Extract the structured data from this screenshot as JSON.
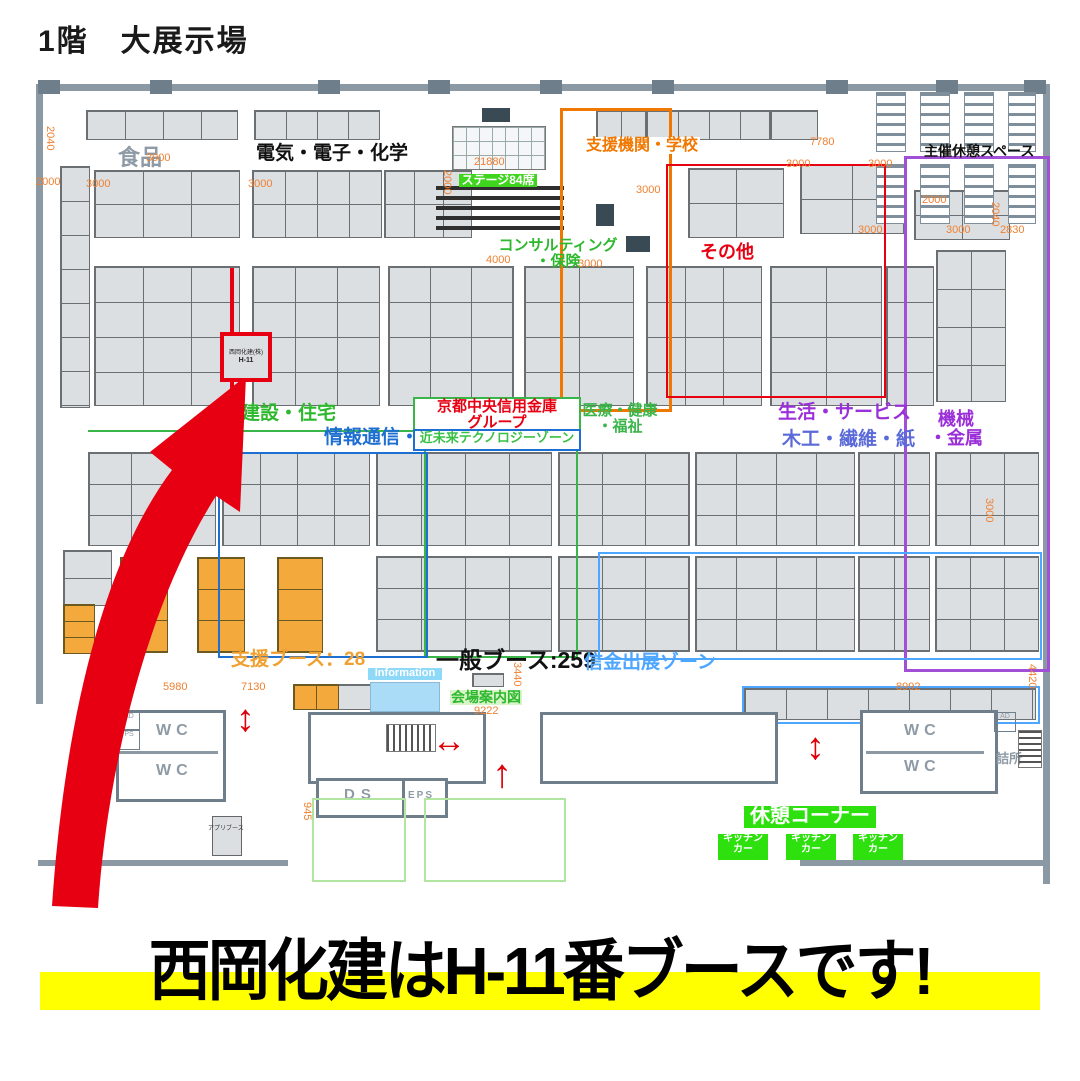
{
  "title": "1階　大展示場",
  "banner": {
    "text": "西岡化建はH-11番ブースです!",
    "highlight_color": "#ffff00"
  },
  "highlight": {
    "company": "西岡化建(株)",
    "booth": "H-11",
    "box_color": "#e60012"
  },
  "zones": {
    "food": {
      "label": "食品",
      "color": "#8e9ba6"
    },
    "electric": {
      "label": "電気・電子・化学",
      "color": "#111111"
    },
    "support_org": {
      "label": "支援機関・学校",
      "color": "#f07800"
    },
    "stage": {
      "label": "ステージ84席",
      "color": "#ffffff",
      "bg": "#3fd41e"
    },
    "consulting": {
      "label": "コンサルティング\n・保険",
      "color": "#2db82d"
    },
    "others": {
      "label": "その他",
      "color": "#e60012"
    },
    "rest_space": {
      "label": "主催休憩スペース",
      "color": "#111111"
    },
    "construction": {
      "label": "建設・住宅",
      "color": "#2db82d"
    },
    "it": {
      "label": "情報通信・IT",
      "color": "#1d6fd1"
    },
    "chuo_shinkin": {
      "label": "京都中央信用金庫\nグループ",
      "color": "#e60012",
      "border": "#39b54a"
    },
    "future_tech": {
      "label": "近未来テクノロジーゾーン",
      "color": "#39c146",
      "border": "#1d6fd1"
    },
    "medical": {
      "label": "医療・健康\n・福祉",
      "color": "#39b54a"
    },
    "life_service": {
      "label": "生活・サービス",
      "color": "#9b30d9"
    },
    "wood": {
      "label": "木工・繊維・紙",
      "color": "#5a6ad8"
    },
    "machine": {
      "label": "機械\n・金属",
      "color": "#9b30d9"
    }
  },
  "counts": {
    "support": "支援ブース：28",
    "general": "一般ブース:259",
    "shinkin": "信金出展ゾーン"
  },
  "facilities": {
    "info": "Information",
    "map_sign": "会場案内図",
    "rest_corner": "休憩コーナー",
    "kitchen": "キッチン\nカー",
    "wc": "WC",
    "staff": "詰所",
    "ds": "DS",
    "eps": "EPS",
    "app_booth": "アプリブース",
    "ad": "AD",
    "ps": "PS"
  },
  "dims": [
    "2040",
    "2000",
    "3000",
    "3000",
    "3000",
    "21880",
    "2000",
    "3000",
    "7780",
    "3000",
    "3000",
    "2000",
    "3000",
    "3000",
    "2040",
    "2830",
    "4000",
    "3000",
    "3000",
    "7130",
    "5980",
    "9222",
    "3440",
    "8992",
    "4420",
    "945"
  ]
}
